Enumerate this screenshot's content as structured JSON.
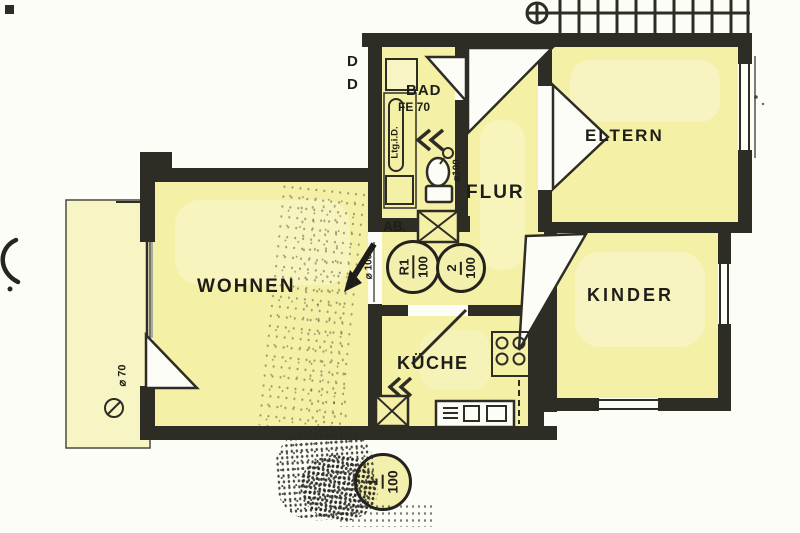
{
  "page": {
    "background": "#fdfdf8"
  },
  "colors": {
    "room_fill": "#f4f0a6",
    "balcony_fill": "#f8f5c4",
    "wall": "#2e2d25",
    "ink": "#1e1d17",
    "paper": "#fdfdf8"
  },
  "labels": {
    "wohnen": "WOHNEN",
    "kueche": "KÜCHE",
    "flur": "FLUR",
    "bad": "BAD",
    "bad_window": "FE 70",
    "eltern": "ELTERN",
    "kinder": "KINDER",
    "shaft": "AB.",
    "duct_note": "Ltg.i.D.",
    "pipe_toilet": "⌀100",
    "pipe_hall": "⌀ 100",
    "pipe_balcony": "⌀ 70",
    "door_letter_1": "D",
    "door_letter_2": "D"
  },
  "vents": [
    {
      "id": "R1",
      "top": "R1",
      "bottom": "100"
    },
    {
      "id": "2",
      "top": "2",
      "bottom": "100"
    },
    {
      "id": "1",
      "top": "1",
      "bottom": "100"
    }
  ],
  "icons": [
    {
      "name": "stairs-icon",
      "shape": "treads-with-newel-circle"
    },
    {
      "name": "toilet-icon",
      "shape": "ellipse-with-tank"
    },
    {
      "name": "shower-icon",
      "shape": "square-tray"
    },
    {
      "name": "stove-icon",
      "shape": "four-burner-circles"
    },
    {
      "name": "sink-icon",
      "shape": "counter-with-basins"
    },
    {
      "name": "shaft-x-icon",
      "shape": "crossed-box"
    },
    {
      "name": "flow-arrow-icon",
      "shape": "solid-arrow-down-left"
    },
    {
      "name": "chevrons-left-icon",
      "shape": "double-chevron"
    },
    {
      "name": "survey-mark-icon",
      "shape": "slashed-circle"
    },
    {
      "name": "scan-artifact-icon",
      "shape": "crescent"
    }
  ]
}
